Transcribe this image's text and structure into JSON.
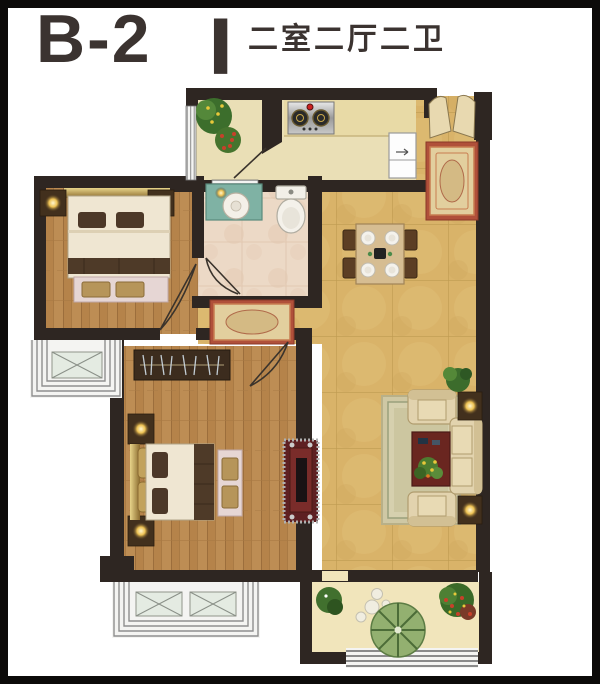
{
  "header": {
    "title": "B-2",
    "divider": "|",
    "subtitle": "二室二厅二卫"
  },
  "palette": {
    "frame": "#0c0a09",
    "title_text": "#3b3330",
    "wall": "#2e2622",
    "wood_floor": "#b5834a",
    "tile_floor": "#d9b369",
    "kitchen_floor": "#eadfb6",
    "bath_floor": "#ecd9c6",
    "balcony_floor": "#f1e5bb",
    "rug_red": "#b0503a",
    "rug_beige": "#e2cf9e",
    "lamp_glow": "#f5d87a",
    "bed_linen": "#efe6d2",
    "blanket_brown": "#4e3a28",
    "sofa_beige": "#e2d3ae",
    "tv_cabinet_maroon": "#5e2022",
    "plant_green": "#3c6e2c"
  }
}
